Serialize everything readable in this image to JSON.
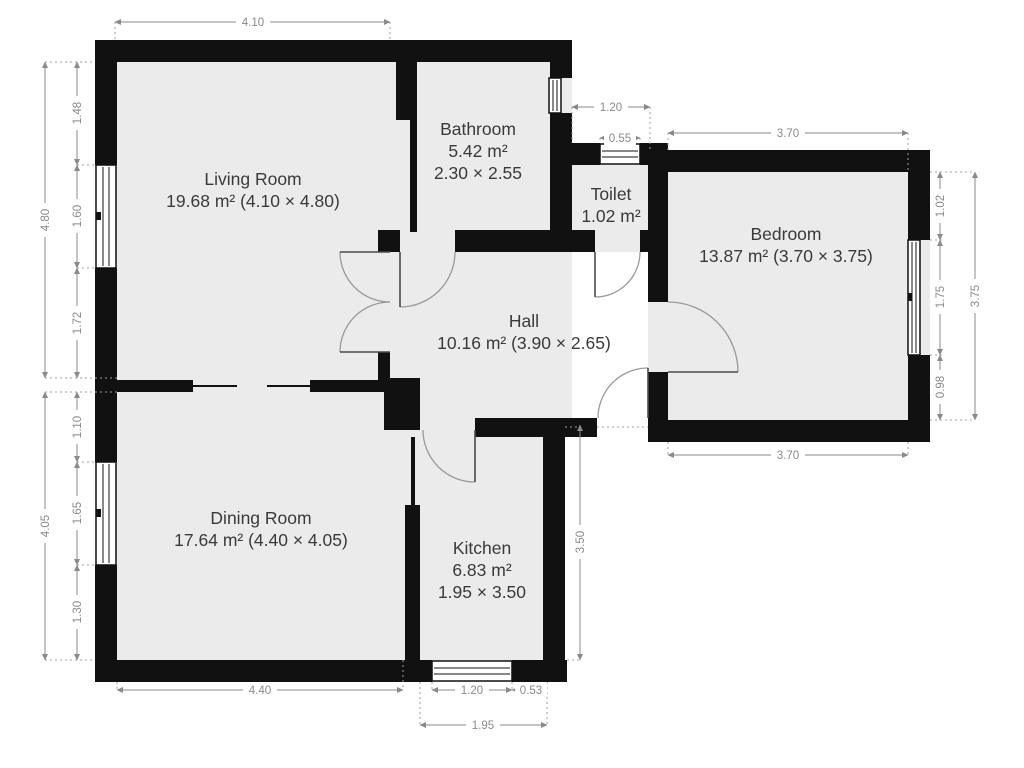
{
  "rooms": {
    "living": {
      "name": "Living Room",
      "details": "19.68 m² (4.10 × 4.80)"
    },
    "dining": {
      "name": "Dining Room",
      "details": "17.64 m² (4.40 × 4.05)"
    },
    "kitchen": {
      "name": "Kitchen",
      "area": "6.83 m²",
      "size": "1.95 × 3.50"
    },
    "bathroom": {
      "name": "Bathroom",
      "area": "5.42 m²",
      "size": "2.30 × 2.55"
    },
    "toilet": {
      "name": "Toilet",
      "area": "1.02 m²"
    },
    "bedroom": {
      "name": "Bedroom",
      "details": "13.87 m² (3.70 × 3.75)"
    },
    "hall": {
      "name": "Hall",
      "details": "10.16 m² (3.90 × 2.65)"
    }
  },
  "dimensions": {
    "top_width": "4.10",
    "left_upper": {
      "total": "4.80",
      "segments": [
        "1.48",
        "1.60",
        "1.72"
      ]
    },
    "left_lower": {
      "total": "4.05",
      "segments": [
        "1.10",
        "1.65",
        "1.30"
      ]
    },
    "toilet_top": {
      "width": "1.20",
      "window": "0.55"
    },
    "bedroom": {
      "top": "3.70",
      "bottom": "3.70",
      "right_total": "3.75",
      "right_segments": [
        "1.02",
        "1.75",
        "0.98"
      ]
    },
    "kitchen": {
      "right": "3.50",
      "bottom_window": "1.20",
      "bottom_right": "0.53",
      "bottom_total": "1.95"
    },
    "dining_bottom": "4.40"
  },
  "colors": {
    "wall": "#111111",
    "room_fill": "#ebebeb",
    "dimension": "#8a8a8a",
    "label": "#3a3a3a"
  }
}
